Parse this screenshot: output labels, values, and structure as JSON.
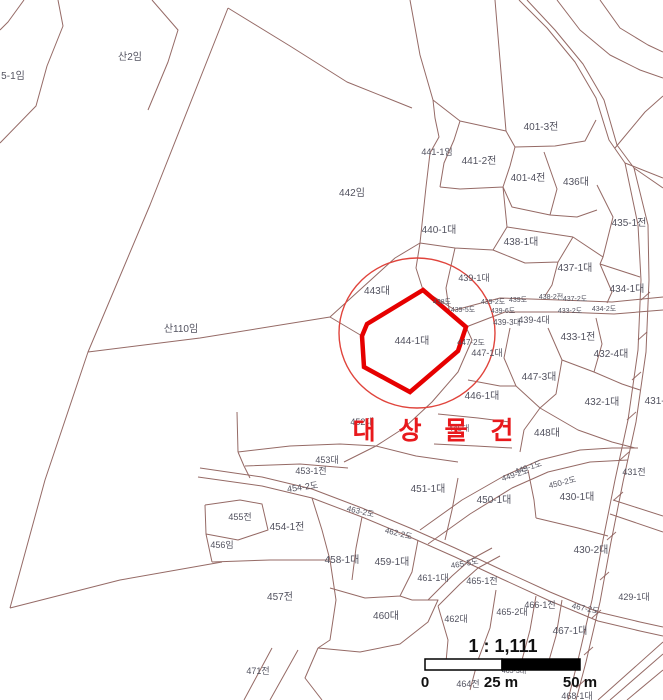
{
  "map": {
    "title": "cadastral-parcel-map",
    "target_label": "대 상 물 건",
    "highlight_parcel": "444-1대",
    "colors": {
      "boundary": "#8a5a55",
      "label": "#52525f",
      "highlight_outline": "#e60000",
      "highlight_circle": "#e0443c",
      "target_text": "#e8191c",
      "background": "#ffffff",
      "scale_bar_fill": "#000000"
    },
    "labels": [
      {
        "text": "5-1임",
        "x": 13,
        "y": 79,
        "s": 10
      },
      {
        "text": "산2임",
        "x": 130,
        "y": 60,
        "s": 10
      },
      {
        "text": "442임",
        "x": 352,
        "y": 196,
        "s": 10
      },
      {
        "text": "산110임",
        "x": 181,
        "y": 332,
        "s": 10
      },
      {
        "text": "441-1임",
        "x": 437,
        "y": 155,
        "s": 9
      },
      {
        "text": "441-2전",
        "x": 479,
        "y": 164,
        "s": 10
      },
      {
        "text": "401-3전",
        "x": 541,
        "y": 130,
        "s": 10
      },
      {
        "text": "401-4전",
        "x": 528,
        "y": 181,
        "s": 10
      },
      {
        "text": "436대",
        "x": 576,
        "y": 185,
        "s": 10
      },
      {
        "text": "435-1전",
        "x": 629,
        "y": 226,
        "s": 10
      },
      {
        "text": "440-1대",
        "x": 439,
        "y": 233,
        "s": 10
      },
      {
        "text": "438-1대",
        "x": 521,
        "y": 245,
        "s": 10
      },
      {
        "text": "437-1대",
        "x": 575,
        "y": 271,
        "s": 10
      },
      {
        "text": "434-1대",
        "x": 627,
        "y": 292,
        "s": 10
      },
      {
        "text": "443대",
        "x": 377,
        "y": 294,
        "s": 10
      },
      {
        "text": "439-1대",
        "x": 474,
        "y": 281,
        "s": 9
      },
      {
        "text": "438도",
        "x": 442,
        "y": 304,
        "s": 7
      },
      {
        "text": "439-5도",
        "x": 463,
        "y": 312,
        "s": 7
      },
      {
        "text": "439-2도",
        "x": 493,
        "y": 304,
        "s": 7
      },
      {
        "text": "439도",
        "x": 518,
        "y": 302,
        "s": 7
      },
      {
        "text": "438-2전",
        "x": 551,
        "y": 299,
        "s": 7
      },
      {
        "text": "437-2도",
        "x": 575,
        "y": 301,
        "s": 7
      },
      {
        "text": "439-6도",
        "x": 503,
        "y": 313,
        "s": 7
      },
      {
        "text": "439-3대",
        "x": 507,
        "y": 325,
        "s": 8
      },
      {
        "text": "439-4대",
        "x": 534,
        "y": 323,
        "s": 9
      },
      {
        "text": "433-2도",
        "x": 570,
        "y": 313,
        "s": 7
      },
      {
        "text": "434-2도",
        "x": 604,
        "y": 311,
        "s": 7
      },
      {
        "text": "433-1전",
        "x": 578,
        "y": 340,
        "s": 10
      },
      {
        "text": "432-4대",
        "x": 611,
        "y": 357,
        "s": 10
      },
      {
        "text": "444-1대",
        "x": 412,
        "y": 344,
        "s": 10
      },
      {
        "text": "447-2도",
        "x": 471,
        "y": 345,
        "s": 8
      },
      {
        "text": "447-1대",
        "x": 487,
        "y": 356,
        "s": 9
      },
      {
        "text": "447-3대",
        "x": 539,
        "y": 380,
        "s": 10
      },
      {
        "text": "432-1대",
        "x": 602,
        "y": 405,
        "s": 10
      },
      {
        "text": "431-3대",
        "x": 662,
        "y": 404,
        "s": 10
      },
      {
        "text": "446-1대",
        "x": 482,
        "y": 399,
        "s": 10
      },
      {
        "text": "445대",
        "x": 459,
        "y": 431,
        "s": 8
      },
      {
        "text": "452대",
        "x": 362,
        "y": 425,
        "s": 9
      },
      {
        "text": "448대",
        "x": 547,
        "y": 436,
        "s": 10
      },
      {
        "text": "449-1도",
        "x": 529,
        "y": 470,
        "s": 8,
        "rot": -18
      },
      {
        "text": "449-2도",
        "x": 516,
        "y": 477,
        "s": 8,
        "rot": -18
      },
      {
        "text": "450-2도",
        "x": 563,
        "y": 485,
        "s": 8,
        "rot": -14
      },
      {
        "text": "431전",
        "x": 634,
        "y": 475,
        "s": 9
      },
      {
        "text": "450-1대",
        "x": 494,
        "y": 503,
        "s": 10
      },
      {
        "text": "430-1대",
        "x": 577,
        "y": 500,
        "s": 10
      },
      {
        "text": "451-1대",
        "x": 428,
        "y": 492,
        "s": 10
      },
      {
        "text": "453대",
        "x": 327,
        "y": 463,
        "s": 9
      },
      {
        "text": "453-1전",
        "x": 311,
        "y": 474,
        "s": 9
      },
      {
        "text": "454-2도",
        "x": 303,
        "y": 490,
        "s": 9,
        "rot": -8
      },
      {
        "text": "455전",
        "x": 240,
        "y": 520,
        "s": 9
      },
      {
        "text": "454-1전",
        "x": 287,
        "y": 530,
        "s": 10
      },
      {
        "text": "456임",
        "x": 222,
        "y": 548,
        "s": 9
      },
      {
        "text": "463-2도",
        "x": 360,
        "y": 514,
        "s": 8,
        "rot": 13
      },
      {
        "text": "462-2도",
        "x": 398,
        "y": 536,
        "s": 8,
        "rot": 14
      },
      {
        "text": "458-1대",
        "x": 342,
        "y": 563,
        "s": 10
      },
      {
        "text": "459-1대",
        "x": 392,
        "y": 565,
        "s": 10
      },
      {
        "text": "461-1대",
        "x": 433,
        "y": 581,
        "s": 9
      },
      {
        "text": "465-5도",
        "x": 465,
        "y": 566,
        "s": 8,
        "rot": -10
      },
      {
        "text": "430-2대",
        "x": 591,
        "y": 553,
        "s": 10
      },
      {
        "text": "457전",
        "x": 280,
        "y": 600,
        "s": 10
      },
      {
        "text": "460대",
        "x": 386,
        "y": 619,
        "s": 10
      },
      {
        "text": "462대",
        "x": 456,
        "y": 622,
        "s": 9
      },
      {
        "text": "465-1전",
        "x": 482,
        "y": 584,
        "s": 9
      },
      {
        "text": "465-2대",
        "x": 512,
        "y": 615,
        "s": 9
      },
      {
        "text": "466-1전",
        "x": 540,
        "y": 608,
        "s": 9
      },
      {
        "text": "467-2도",
        "x": 585,
        "y": 611,
        "s": 8,
        "rot": 12
      },
      {
        "text": "429-1대",
        "x": 634,
        "y": 600,
        "s": 9
      },
      {
        "text": "467-1대",
        "x": 570,
        "y": 634,
        "s": 10
      },
      {
        "text": "465-3대",
        "x": 514,
        "y": 673,
        "s": 7
      },
      {
        "text": "464전",
        "x": 468,
        "y": 687,
        "s": 9
      },
      {
        "text": "468-1대",
        "x": 577,
        "y": 699,
        "s": 9
      },
      {
        "text": "471전",
        "x": 258,
        "y": 674,
        "s": 9
      }
    ]
  },
  "scale_bar": {
    "ratio": "1 : 1,111",
    "zero": "0",
    "mid": "25 m",
    "max": "50 m"
  }
}
